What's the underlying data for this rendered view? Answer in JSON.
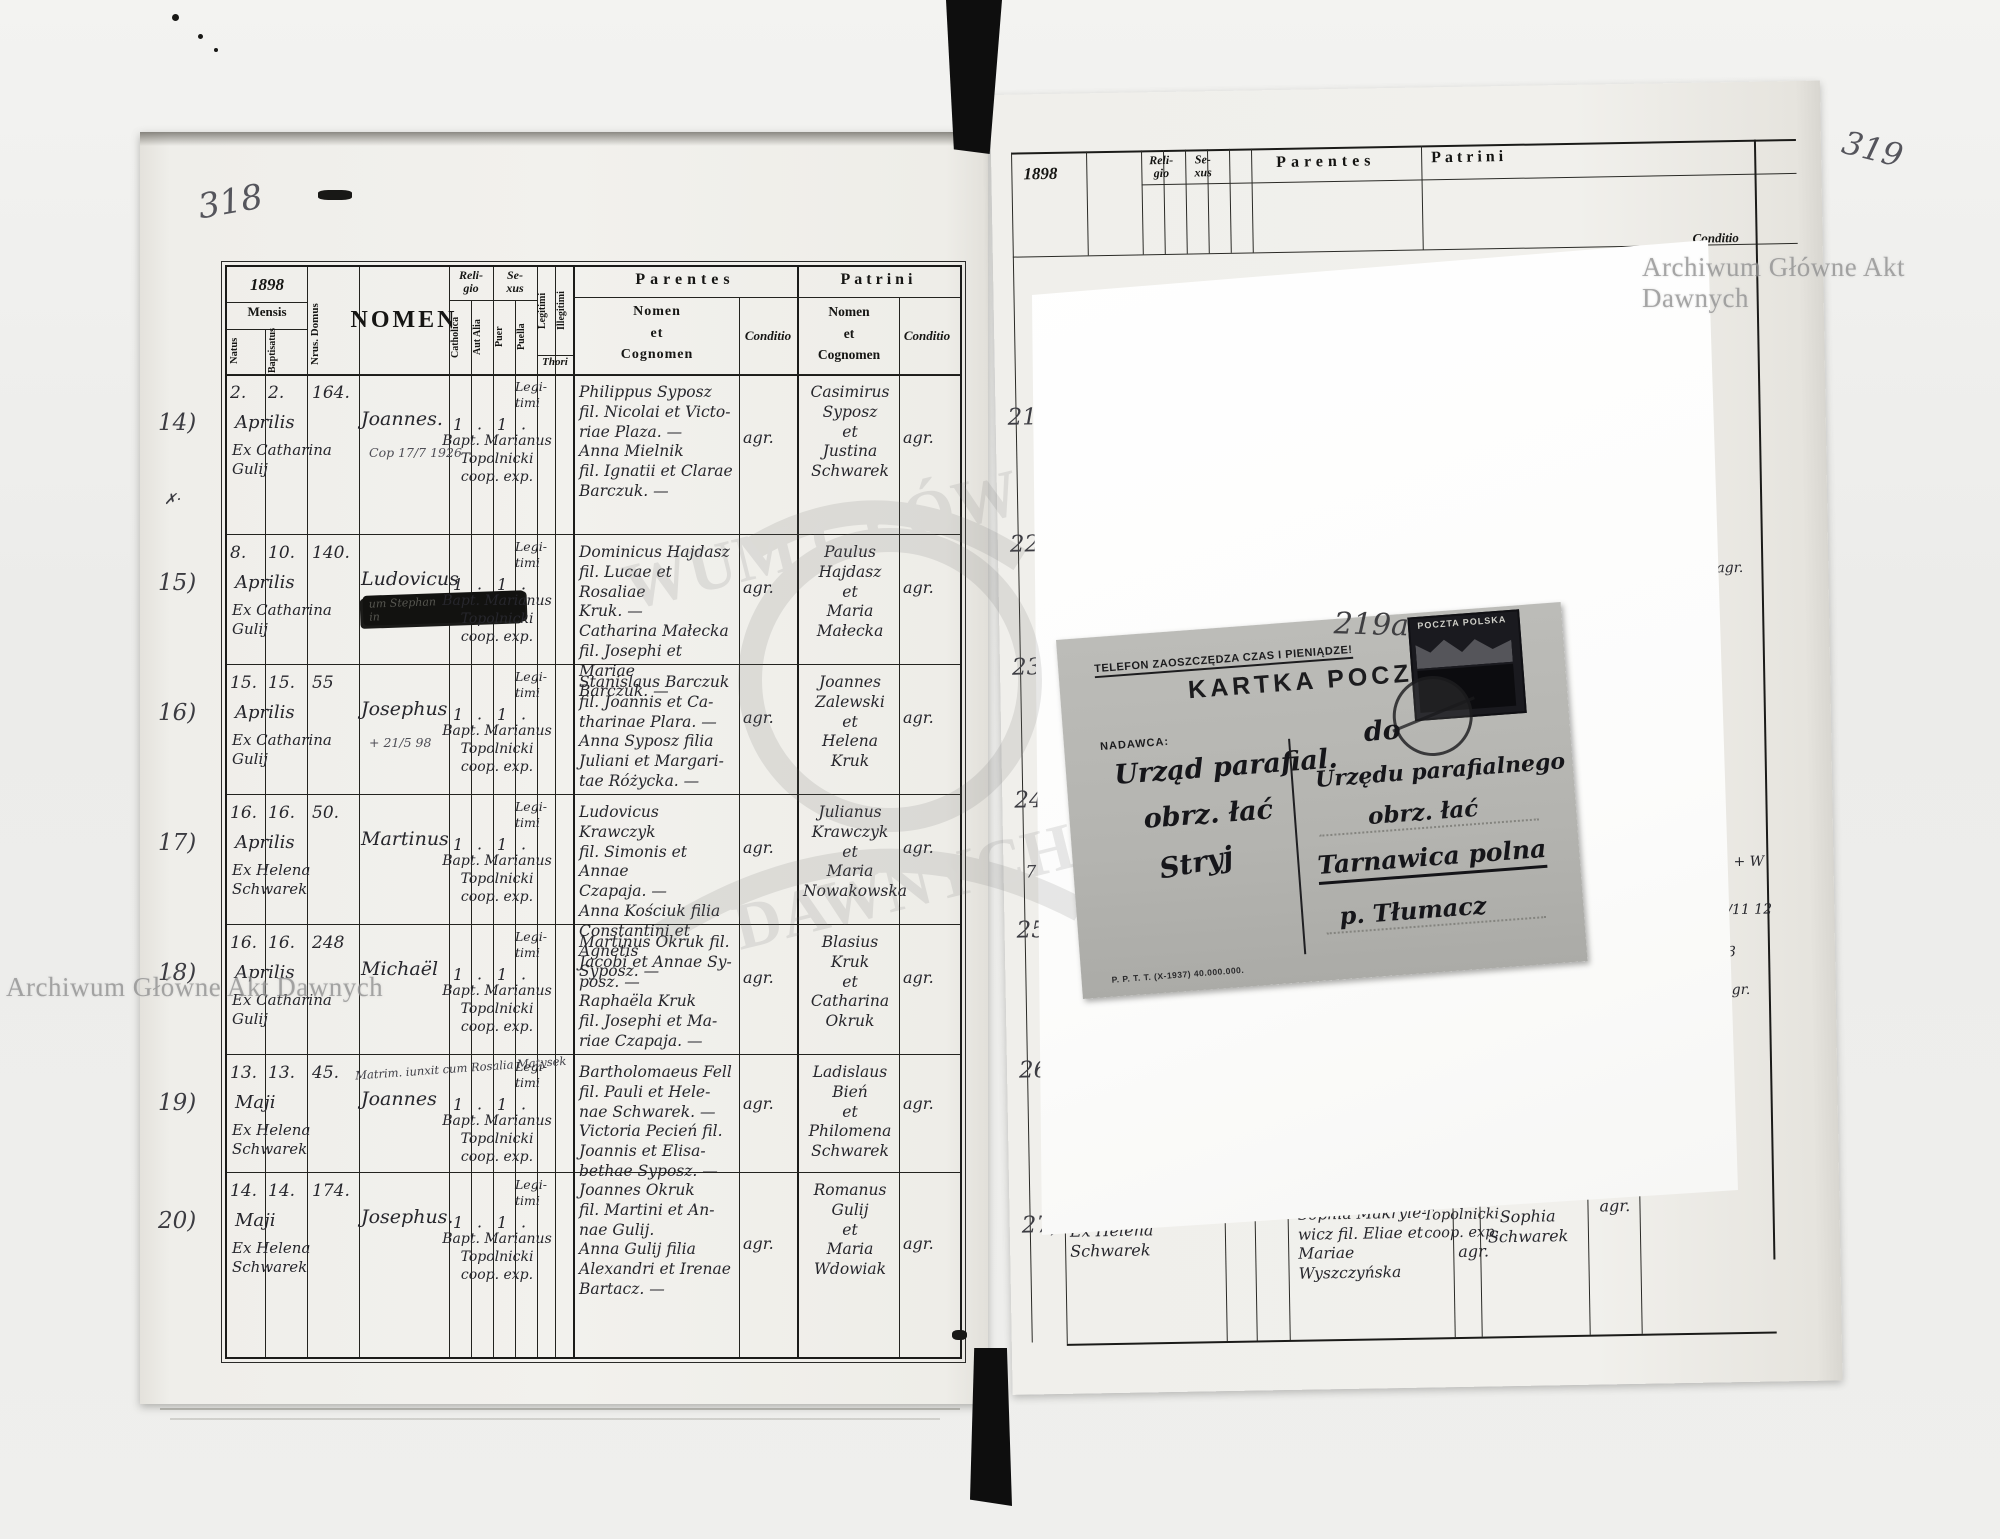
{
  "watermarks": {
    "top_right": "Archiwum Główne Akt Dawnych",
    "bottom_left": "Archiwum Główne Akt Dawnych",
    "ghost_line1": "WUM GŁÓW",
    "ghost_line2": "DAWNYCH"
  },
  "left_page": {
    "page_number": "318",
    "margin_mark": "✗·",
    "header": {
      "year": "1898",
      "mensis": "Mensis",
      "natus": "Natus",
      "baptisatus": "Baptisatus",
      "nrus_domus": "Nrus. Domus",
      "nomen": "NOMEN",
      "religio": "Reli-\ngio",
      "catholica": "Catholica",
      "aut_alia": "Aut Alia",
      "sexus": "Se-\nxus",
      "puer": "Puer",
      "puella": "Puella",
      "legitimi": "Legitimi",
      "illegitimi": "Illegitimi",
      "thori": "Thori",
      "parentes": "Parentes",
      "patrini": "Patrini",
      "nomen_et_cognomen": "Nomen\net\nCognomen",
      "conditio": "Conditio"
    },
    "records": [
      {
        "margin_no": "14)",
        "natus": "2.",
        "baptisatus": "2.",
        "month": "Aprilis",
        "ex": "Ex Catharina\nGulij",
        "house": "164.",
        "name": "Joannes.",
        "note": "Cop 17/7 1926",
        "rel_cath": "1",
        "rel_aut": "·",
        "sex_puer": "1",
        "sex_puella": "·",
        "baptizer": "Bapt. Marianus\nTopolnicki\ncoop. exp.",
        "legit": "Legi-\ntimi",
        "parents": "Philippus Syposz\nfil. Nicolai et Victo-\nriae Plaza. —\nAnna Mielnik\nfil. Ignatii et Clarae\nBarczuk. —",
        "cond1": "agr.",
        "patrini": "Casimirus\nSyposz\net\nJustina\nSchwarek",
        "cond2": "agr."
      },
      {
        "margin_no": "15)",
        "natus": "8.",
        "baptisatus": "10.",
        "month": "Aprilis",
        "ex": "Ex Catharina\nGulij",
        "house": "140.",
        "name": "Ludovicus",
        "blot": "um Stephan\nin",
        "rel_cath": "1",
        "rel_aut": "·",
        "sex_puer": "1",
        "sex_puella": "·",
        "baptizer": "Bapt. Marianus\nTopolnicki\ncoop. exp.",
        "legit": "Legi-\ntimi",
        "parents": "Dominicus Hajdasz\nfil. Lucae et Rosaliae\nKruk. —\nCatharina Małecka\nfil. Josephi et Mariae\nBarczuk. —",
        "cond1": "agr.",
        "patrini": "Paulus\nHajdasz\net\nMaria\nMałecka",
        "cond2": "agr."
      },
      {
        "margin_no": "16)",
        "natus": "15.",
        "baptisatus": "15.",
        "month": "Aprilis",
        "ex": "Ex Catharina\nGulij",
        "house": "55",
        "name": "Josephus",
        "note": "+ 21/5 98",
        "rel_cath": "1",
        "rel_aut": "·",
        "sex_puer": "1",
        "sex_puella": "·",
        "baptizer": "Bapt. Marianus\nTopolnicki\ncoop. exp.",
        "legit": "Legi-\ntimi",
        "parents": "Stanislaus Barczuk\nfil. Joannis et Ca-\ntharinae Plara. —\nAnna Syposz filia\nJuliani et Margari-\ntae Różycka. —",
        "cond1": "agr.",
        "patrini": "Joannes\nZalewski\net\nHelena\nKruk",
        "cond2": "agr."
      },
      {
        "margin_no": "17)",
        "natus": "16.",
        "baptisatus": "16.",
        "month": "Aprilis",
        "ex": "Ex Helena\nSchwarek",
        "house": "50.",
        "name": "Martinus",
        "rel_cath": "1",
        "rel_aut": "·",
        "sex_puer": "1",
        "sex_puella": "·",
        "baptizer": "Bapt. Marianus\nTopolnicki\ncoop. exp.",
        "legit": "Legi-\ntimi",
        "parents": "Ludovicus Krawczyk\nfil. Simonis et Annae\nCzapaja. —\nAnna Kościuk filia\nConstantini et Agnetis\nSyposz. —",
        "cond1": "agr.",
        "patrini": "Julianus\nKrawczyk\net\nMaria\nNowakowska",
        "cond2": "agr."
      },
      {
        "margin_no": "18)",
        "natus": "16.",
        "baptisatus": "16.",
        "month": "Aprilis",
        "ex": "Ex Catharina\nGulij",
        "house": "248",
        "name": "Michaël",
        "rel_cath": "1",
        "rel_aut": "·",
        "sex_puer": "1",
        "sex_puella": "·",
        "baptizer": "Bapt. Marianus\nTopolnicki\ncoop. exp.",
        "legit": "Legi-\ntimi",
        "parents": "Martinus Okruk fil.\nJacobi et Annae Sy-\nposz. —\nRaphaëla Kruk\nfil. Josephi et Ma-\nriae Czapaja. —",
        "cond1": "agr.",
        "patrini": "Blasius\nKruk\net\nCatharina\nOkruk",
        "cond2": "agr."
      },
      {
        "margin_no": "19)",
        "natus": "13.",
        "baptisatus": "13.",
        "month": "Maji",
        "ex": "Ex Helena\nSchwarek",
        "house": "45.",
        "name": "Joannes",
        "note2": "Matrim. iunxit cum Rosalia Matysek",
        "rel_cath": "1",
        "rel_aut": "·",
        "sex_puer": "1",
        "sex_puella": "·",
        "baptizer": "Bapt. Marianus\nTopolnicki\ncoop. exp.",
        "legit": "Legi-\ntimi",
        "parents": "Bartholomaeus Fell\nfil. Pauli et Hele-\nnae Schwarek. —\nVictoria Pecień fil.\nJoannis et Elisa-\nbethae Syposz. —",
        "cond1": "agr.",
        "patrini": "Ladislaus\nBień\net\nPhilomena\nSchwarek",
        "cond2": "agr."
      },
      {
        "margin_no": "20)",
        "natus": "14.",
        "baptisatus": "14.",
        "month": "Maji",
        "ex": "Ex Helena\nSchwarek",
        "house": "174.",
        "name": "Josephus.",
        "rel_cath": "1",
        "rel_aut": "·",
        "sex_puer": "1",
        "sex_puella": "·",
        "baptizer": "Bapt. Marianus\nTopolnicki\ncoop. exp.",
        "legit": "Legi-\ntimi",
        "parents": "Joannes Okruk\nfil. Martini et An-\nnae Gulij.\nAnna Gulij filia\nAlexandri et Irenae\nBartacz. —",
        "cond1": "agr.",
        "patrini": "Romanus\nGulij\net\nMaria\nWdowiak",
        "cond2": "agr."
      }
    ]
  },
  "right_page": {
    "page_number": "319",
    "header": {
      "year": "1898",
      "religio": "Reli-\ngio",
      "sexus": "Se-\nxus",
      "parentes": "Parentes",
      "patrini": "Patrini",
      "conditio": "Conditio"
    },
    "margin_numbers": [
      "21)",
      "22)",
      "23)",
      "24)",
      "25)",
      "26)",
      "27)"
    ],
    "margin_extra": "7",
    "edge_notes": [
      "agr.",
      "+ W",
      "2/11 12",
      "3",
      "gr."
    ],
    "bottom_record": {
      "ex": "Ex Helena\nSchwarek",
      "cross": "+",
      "baptizer": "Bapt. Marianus\nTopolnicki\ncoop. exp.",
      "parents": "Makrylewicz. —\nSophia Makryle-\nwicz fil. Eliae et\nMariae Wyszczyńska",
      "parents_conditio": "agr.",
      "patrini": "Bień\net\nSophia\nSchwarek",
      "patrini_conditio": "agr."
    }
  },
  "postcard": {
    "slogan": "TELEFON ZAOSZCZĘDZA CZAS I PIENIĄDZE!",
    "title": "KARTKA POCZTOWA",
    "pencil_number": "219a",
    "stamp": {
      "country": "POCZTA POLSKA",
      "value": "15"
    },
    "sender_label": "NADAWCA:",
    "sender_lines": [
      "Urząd parafial.",
      "obrz. łać",
      "Stryj"
    ],
    "addressee_intro": "do",
    "addressee_line1": "Urzędu parafialnego",
    "addressee_line2": "obrz. łać",
    "addressee_place": "Tarnawica polna",
    "addressee_post": "p. Tłumacz",
    "imprint": "P. P. T. T. (X-1937) 40.000.000."
  }
}
